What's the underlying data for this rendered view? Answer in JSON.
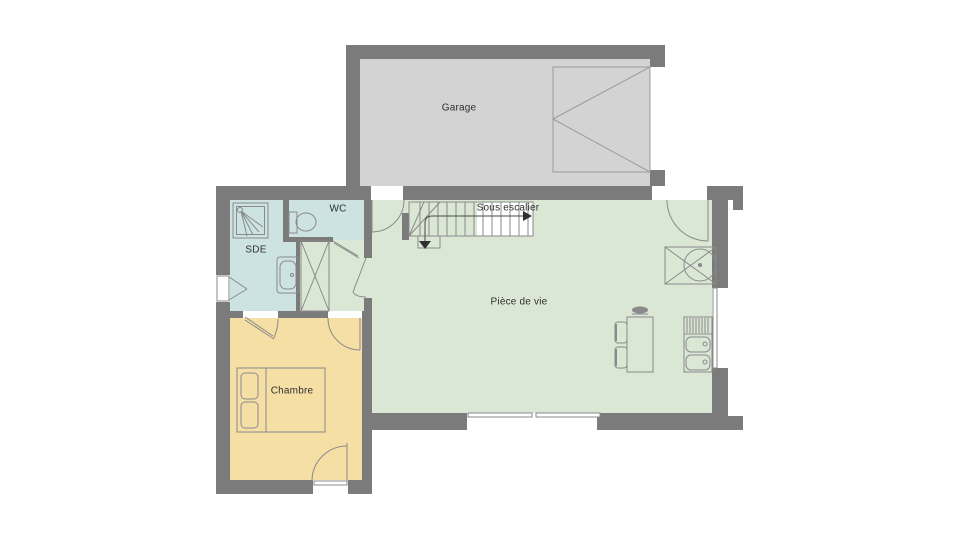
{
  "rooms": {
    "garage": {
      "label": "Garage",
      "color": "#d3d3d3"
    },
    "piece_de_vie": {
      "label": "Pièce de vie",
      "color": "#dbe7d5"
    },
    "sde": {
      "label": "SDE",
      "color": "#cde3e1"
    },
    "wc": {
      "label": "WC",
      "color": "#cde3e1"
    },
    "chambre": {
      "label": "Chambre",
      "color": "#f6dfa5"
    },
    "sous_escalier": {
      "label": "Sous escalier"
    }
  },
  "colors": {
    "wall": "#7b7b7b",
    "line": "#8a8a8a",
    "background": "#ffffff",
    "label_text": "#2f2f2f"
  }
}
